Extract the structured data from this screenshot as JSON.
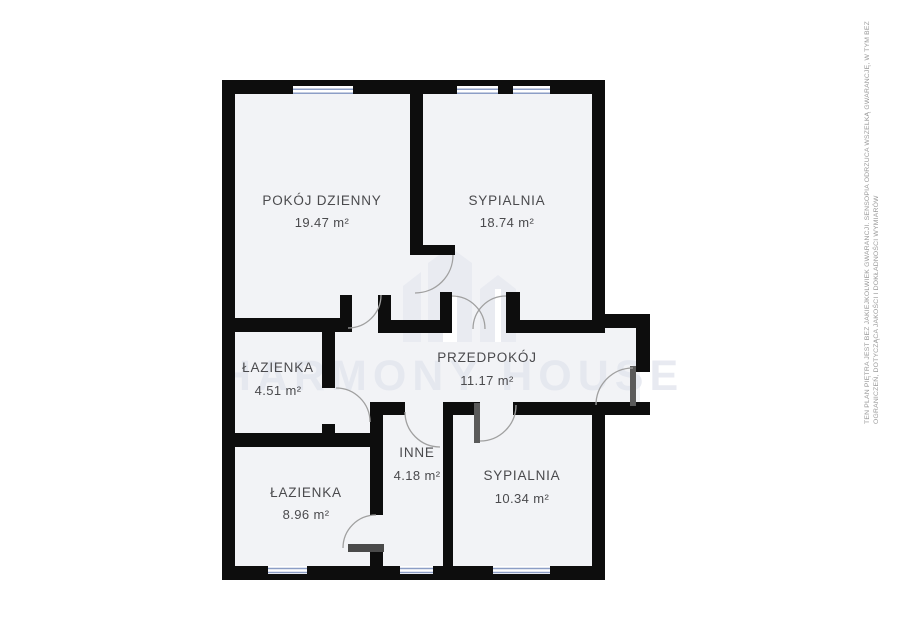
{
  "plan": {
    "rooms": [
      {
        "id": "pokoj-dzienny",
        "name": "POKÓJ DZIENNY",
        "area": "19.47 m²"
      },
      {
        "id": "sypialnia-gorna",
        "name": "SYPIALNIA",
        "area": "18.74 m²"
      },
      {
        "id": "lazienka-mala",
        "name": "ŁAZIENKA",
        "area": "4.51 m²"
      },
      {
        "id": "przedpokoj",
        "name": "PRZEDPOKÓJ",
        "area": "11.17 m²"
      },
      {
        "id": "inne",
        "name": "INNE",
        "area": "4.18 m²"
      },
      {
        "id": "lazienka-duza",
        "name": "ŁAZIENKA",
        "area": "8.96 m²"
      },
      {
        "id": "sypialnia-dolna",
        "name": "SYPIALNIA",
        "area": "10.34 m²"
      }
    ],
    "watermark": {
      "text": "HARMONY HOUSE",
      "logo": "buildings-icon"
    },
    "disclaimer": {
      "line1": "TEN PLAN PIĘTRA JEST BEZ JAKIEJKOLWIEK GWARANCJI. SENSOPIA ODRZUCA WSZELKĄ GWARANCJĘ, W TYM BEZ",
      "line2": "OGRANICZEŃ, DOTYCZĄCA JAKOŚCI I DOKŁADNOŚCI WYMIARÓW"
    },
    "colors": {
      "wall": "#0d0d0d",
      "room_fill": "#f2f3f6",
      "window_glass": "#8c9ec6",
      "door_arc": "#a0a0a0",
      "label": "#4a4a4d",
      "watermark": "#e3e6ee",
      "disclaimer": "#9a9a9a"
    }
  }
}
